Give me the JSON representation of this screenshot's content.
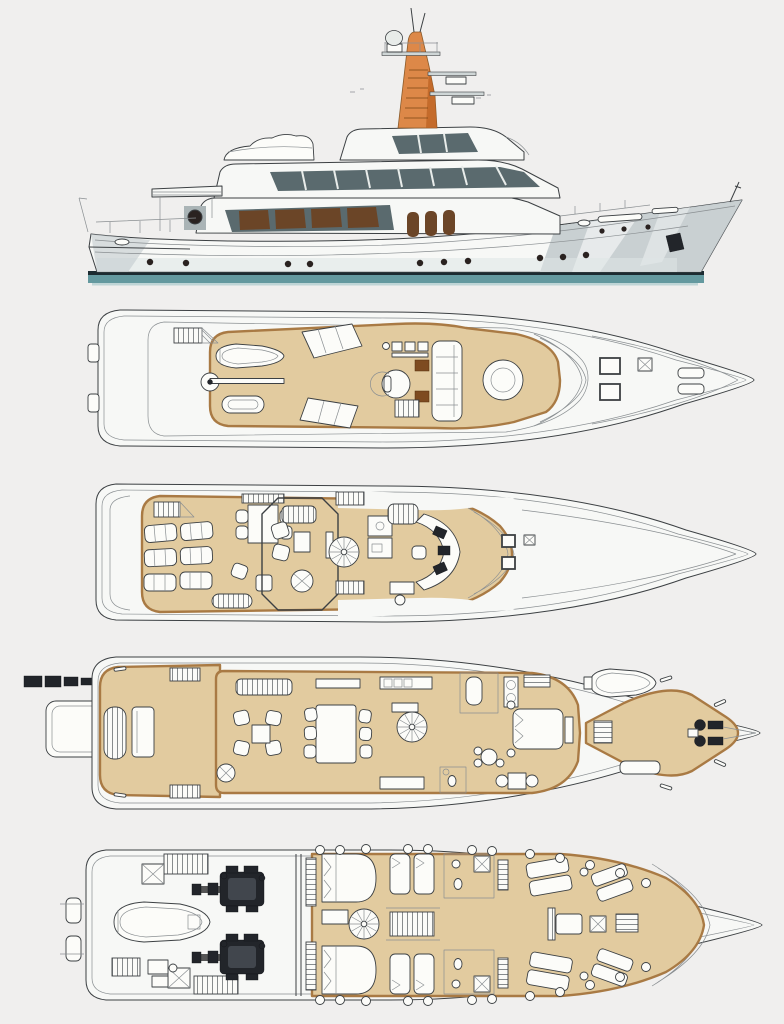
{
  "document": {
    "type": "yacht-general-arrangement-drawing",
    "views": [
      {
        "id": "profile-elevation"
      },
      {
        "id": "sun-deck-plan"
      },
      {
        "id": "upper-deck-plan"
      },
      {
        "id": "main-deck-plan"
      },
      {
        "id": "lower-deck-plan"
      }
    ]
  },
  "palette": {
    "page_bg": "#f0efee",
    "line": "#3c4043",
    "line_soft": "#8a8f92",
    "hull_white": "#f7f8f6",
    "hull_shade": "#c3cbce",
    "hull_shade_dark": "#9aa6aa",
    "glass_dark": "#5a6a6e",
    "window_brown": "#6b4527",
    "mast_orange": "#dd8848",
    "mast_orange_dark": "#b9601f",
    "waterline_dark": "#1c2b31",
    "waterline_teal": "#4b8a91",
    "deck_tan": "#e2cb9f",
    "deck_walk": "#cda774",
    "deck_trim": "#a97a44",
    "accent_brown": "#7e4b20",
    "furniture": "#fcfcf9",
    "machinery": "#22252a"
  }
}
